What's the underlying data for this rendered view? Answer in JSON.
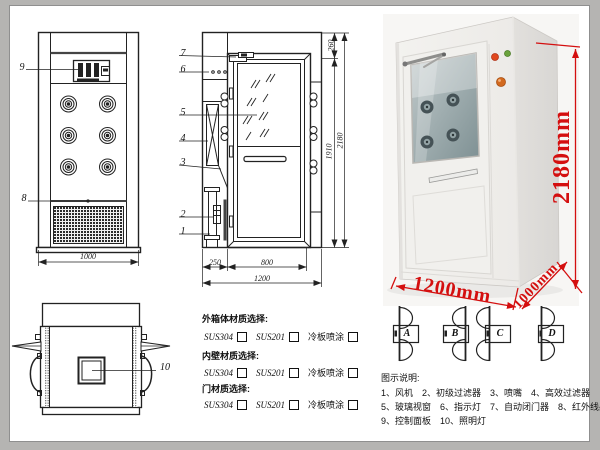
{
  "colors": {
    "dimension_red": "#d40f0f",
    "line_color": "#222222"
  },
  "front_view": {
    "label_control_panel": "9",
    "label_grille": "8",
    "dim_width": "1000"
  },
  "side_view": {
    "labels": [
      "7",
      "6",
      "5",
      "4",
      "3",
      "2",
      "1"
    ],
    "dim_top": "260",
    "dim_door_height": "1910",
    "dim_total_height": "2180",
    "dim_left_section": "250",
    "dim_door_width": "800",
    "dim_total_width": "1200"
  },
  "top_view": {
    "label_lamp": "10"
  },
  "photo": {
    "dim_height": "2180mm",
    "dim_width": "1200mm",
    "dim_depth": "1000mm"
  },
  "materials": {
    "groups": [
      {
        "title": "外箱体材质选择:",
        "options": [
          "SUS304",
          "SUS201",
          "冷板喷涂"
        ]
      },
      {
        "title": "内壁材质选择:",
        "options": [
          "SUS304",
          "SUS201",
          "冷板喷涂"
        ]
      },
      {
        "title": "门材质选择:",
        "options": [
          "SUS304",
          "SUS201",
          "冷板喷涂"
        ]
      }
    ]
  },
  "door_options": [
    "A",
    "B",
    "C",
    "D"
  ],
  "legend": {
    "title": "图示说明:",
    "rows": [
      [
        "1、风机",
        "2、初级过滤器",
        "3、喷嘴",
        "4、高效过滤器"
      ],
      [
        "5、玻璃视窗",
        "6、指示灯",
        "7、自动闭门器",
        "8、红外线感应器"
      ],
      [
        "9、控制面板",
        "10、照明灯"
      ]
    ]
  }
}
